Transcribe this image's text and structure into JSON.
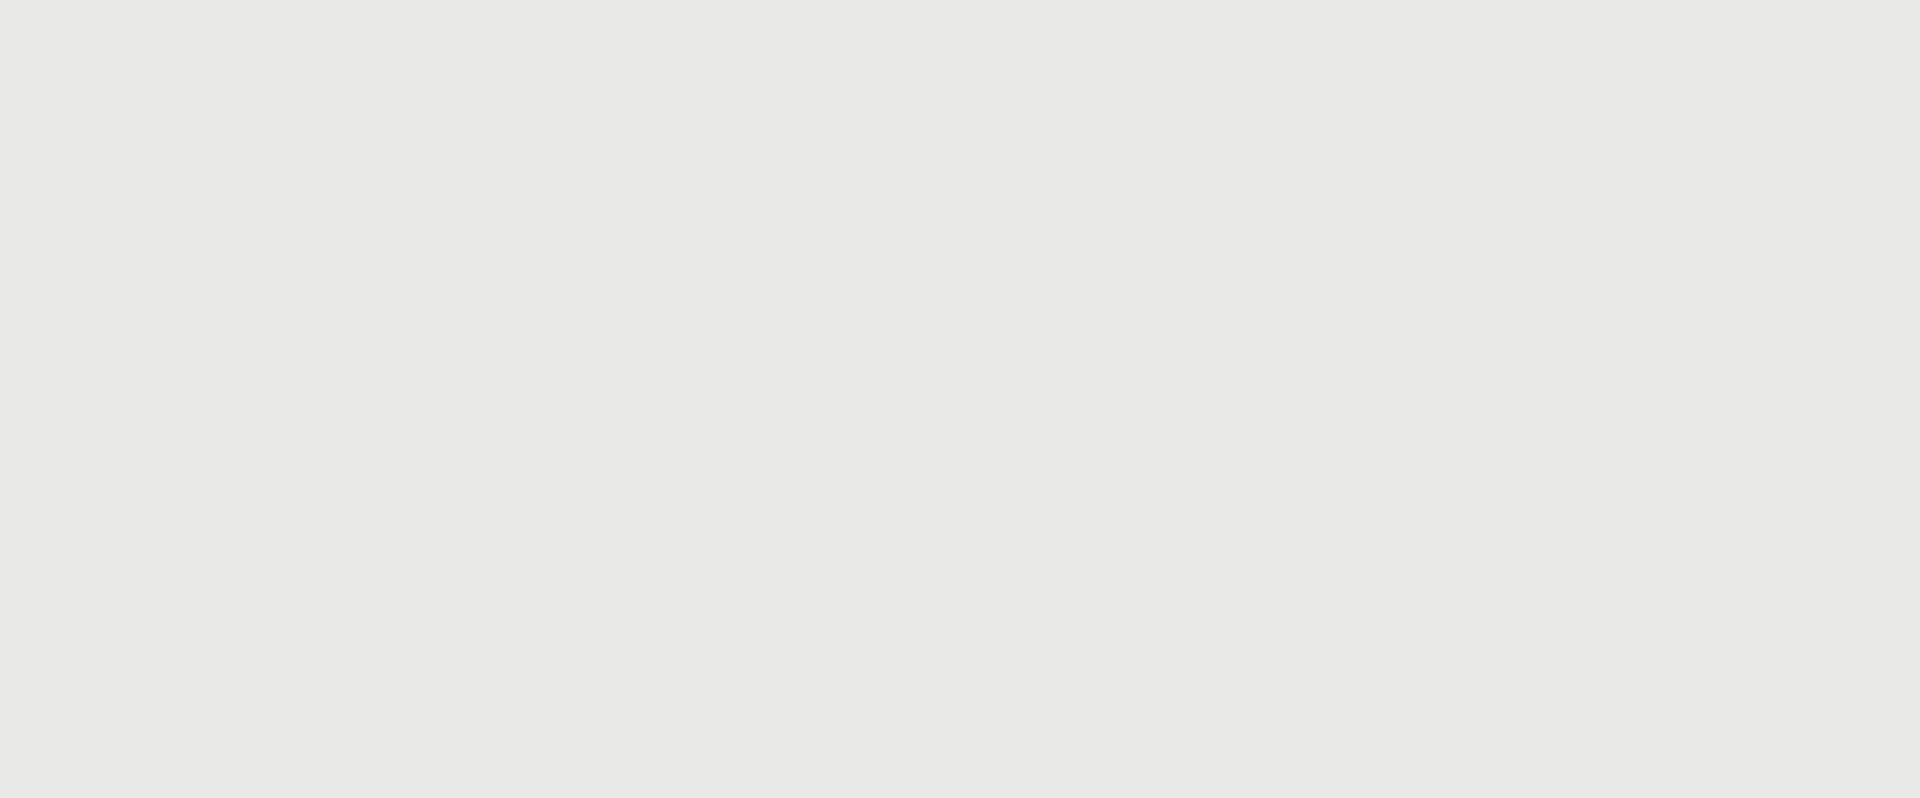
{
  "title": {
    "text": "RZUT  SKALA 1:100"
  },
  "streets": {
    "left": "UL. KALWARYJSKA",
    "right": "UL. JANA ZAMOYSKIEGO"
  },
  "section_markers": {
    "left_b": "B",
    "left_a": "A",
    "right_b": "B",
    "right_a": "A"
  },
  "callouts": [
    "PLAC/ MIEJSCE POSTOJOWE",
    "ŁAWKA BETONOWA",
    "ŁAWKI ZE STOLIKAMI",
    "LATARNIE ULICZNE",
    "ŁAWKI ZE STOLIKAMI",
    "OŚWIETLENIE POSADZKOWE",
    "STOLIK",
    "WINDA",
    "DONICA Z ZIELENIA",
    "POMOST",
    "HUŚTAWKI"
  ],
  "elevations": [
    "205,02",
    "208,97",
    "214,23",
    "208,46",
    "208,77",
    "211,02",
    "214,26",
    "214,23",
    "205,02"
  ],
  "slopes": [
    "4%",
    "1,4%",
    "2%"
  ],
  "stairs": [
    {
      "line1": "15X17",
      "line2": "30"
    },
    {
      "line1": "14X17",
      "line2": "30"
    },
    {
      "line1": "17X17",
      "line2": "30"
    }
  ],
  "dimensions": {
    "top": "1295",
    "bottom": [
      "378",
      "1123",
      "225",
      "420",
      "747",
      "390",
      "759",
      "480",
      "371"
    ],
    "interior": [
      "1123",
      "225",
      "420",
      "747",
      "390",
      "759",
      "480"
    ],
    "left_column": [
      "78",
      "313",
      "77",
      "50"
    ],
    "small": [
      "398",
      "386",
      "346",
      "274",
      "467",
      "145",
      "392",
      "172",
      "302",
      "398",
      "368",
      "407"
    ]
  },
  "colors": {
    "plaza_red": "#c4584a",
    "plaza_red_light": "#db8e79",
    "background": "#e9e9e8",
    "greenery": "#6f7239",
    "line_black": "#17140f"
  }
}
